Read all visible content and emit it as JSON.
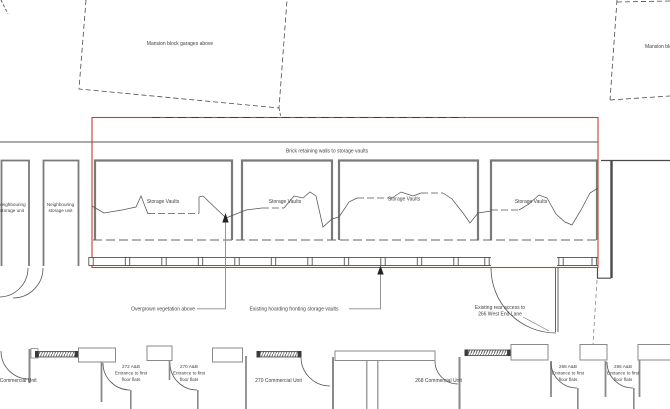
{
  "colors": {
    "boundary_red": "#c4402f",
    "wall_gray": "#8a8a8a",
    "line_dark": "#4a4a4a"
  },
  "labels": {
    "mansion_left": "Mansion block garages above",
    "mansion_right": "Mansion block",
    "brick_retaining": "Brick retaining walls to storage vaults",
    "overgrown": "Overgrown vegetation above",
    "hoarding": "Existing hoarding fronting storage vaults",
    "rear_access_1": "Existing rear access to",
    "rear_access_2": "266 West End Lane"
  },
  "neighbouring_units": [
    {
      "line1": "Neighbouring",
      "line2": "storage unit"
    },
    {
      "line1": "Neighbouring",
      "line2": "storage unit"
    }
  ],
  "vaults": [
    {
      "label": "Storage Vaults"
    },
    {
      "label": "Storage Vaults"
    },
    {
      "label": "Storage Vaults"
    },
    {
      "label": "Storage Vaults"
    }
  ],
  "street_units": {
    "commercial_272": "272 Commercial Unit",
    "entrance_272": {
      "l1": "272 A&B",
      "l2": "Entrance to first",
      "l3": "floor flats"
    },
    "entrance_270": {
      "l1": "270 A&B",
      "l2": "Entrance to first",
      "l3": "floor flats"
    },
    "commercial_270": "270 Commercial Unit",
    "commercial_268": "268 Commercial Unit",
    "entrance_268": {
      "l1": "268 A&B",
      "l2": "Entrance to first",
      "l3": "floor flats"
    },
    "entrance_266": {
      "l1": "266 A&B",
      "l2": "Entrance to first",
      "l3": "floor flats"
    }
  }
}
